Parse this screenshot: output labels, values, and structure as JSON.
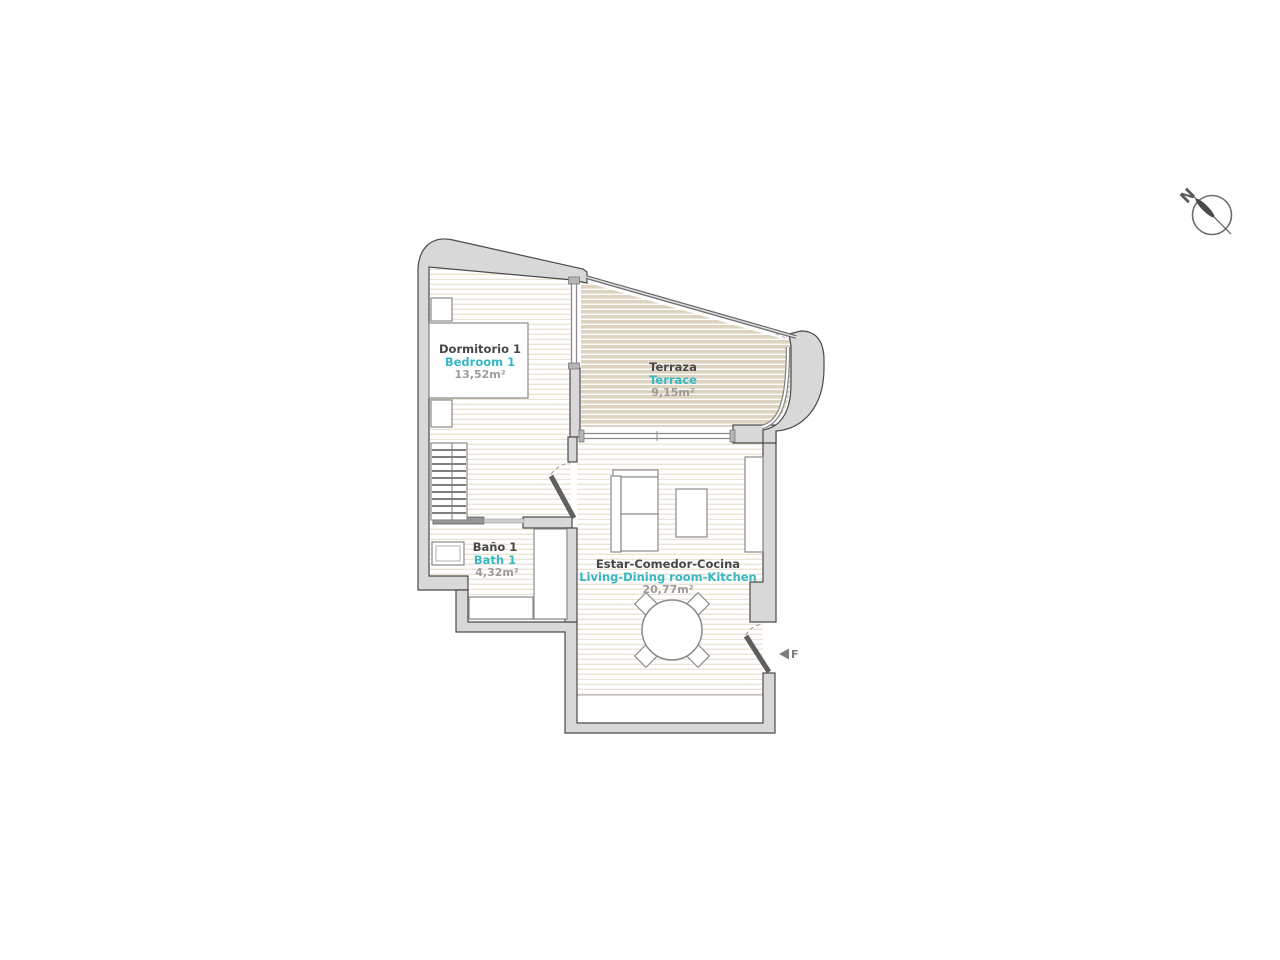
{
  "title": "Apartment floor plan",
  "compass": {
    "north_label": "N"
  },
  "entry_marker": {
    "label": "F"
  },
  "rooms": [
    {
      "id": "bedroom",
      "name_es": "Dormitorio 1",
      "name_en": "Bedroom 1",
      "area": "13,52m²"
    },
    {
      "id": "terrace",
      "name_es": "Terraza",
      "name_en": "Terrace",
      "area": "9,15m²"
    },
    {
      "id": "bath",
      "name_es": "Baño 1",
      "name_en": "Bath 1",
      "area": "4,32m²"
    },
    {
      "id": "living",
      "name_es": "Estar-Comedor-Cocina",
      "name_en": "Living-Dining room-Kitchen",
      "area": "20,77m²"
    }
  ],
  "colors": {
    "accent_cyan": "#35b8c4",
    "label_dark": "#474747",
    "label_gray": "#9b9b9b",
    "wall_fill": "#d8d8d8",
    "wall_edge": "#4a4a4a",
    "terrace_fill": "#ddd3c0",
    "floor_stripe": "#eae2d3",
    "fixture_stroke": "#8a8a8a"
  }
}
